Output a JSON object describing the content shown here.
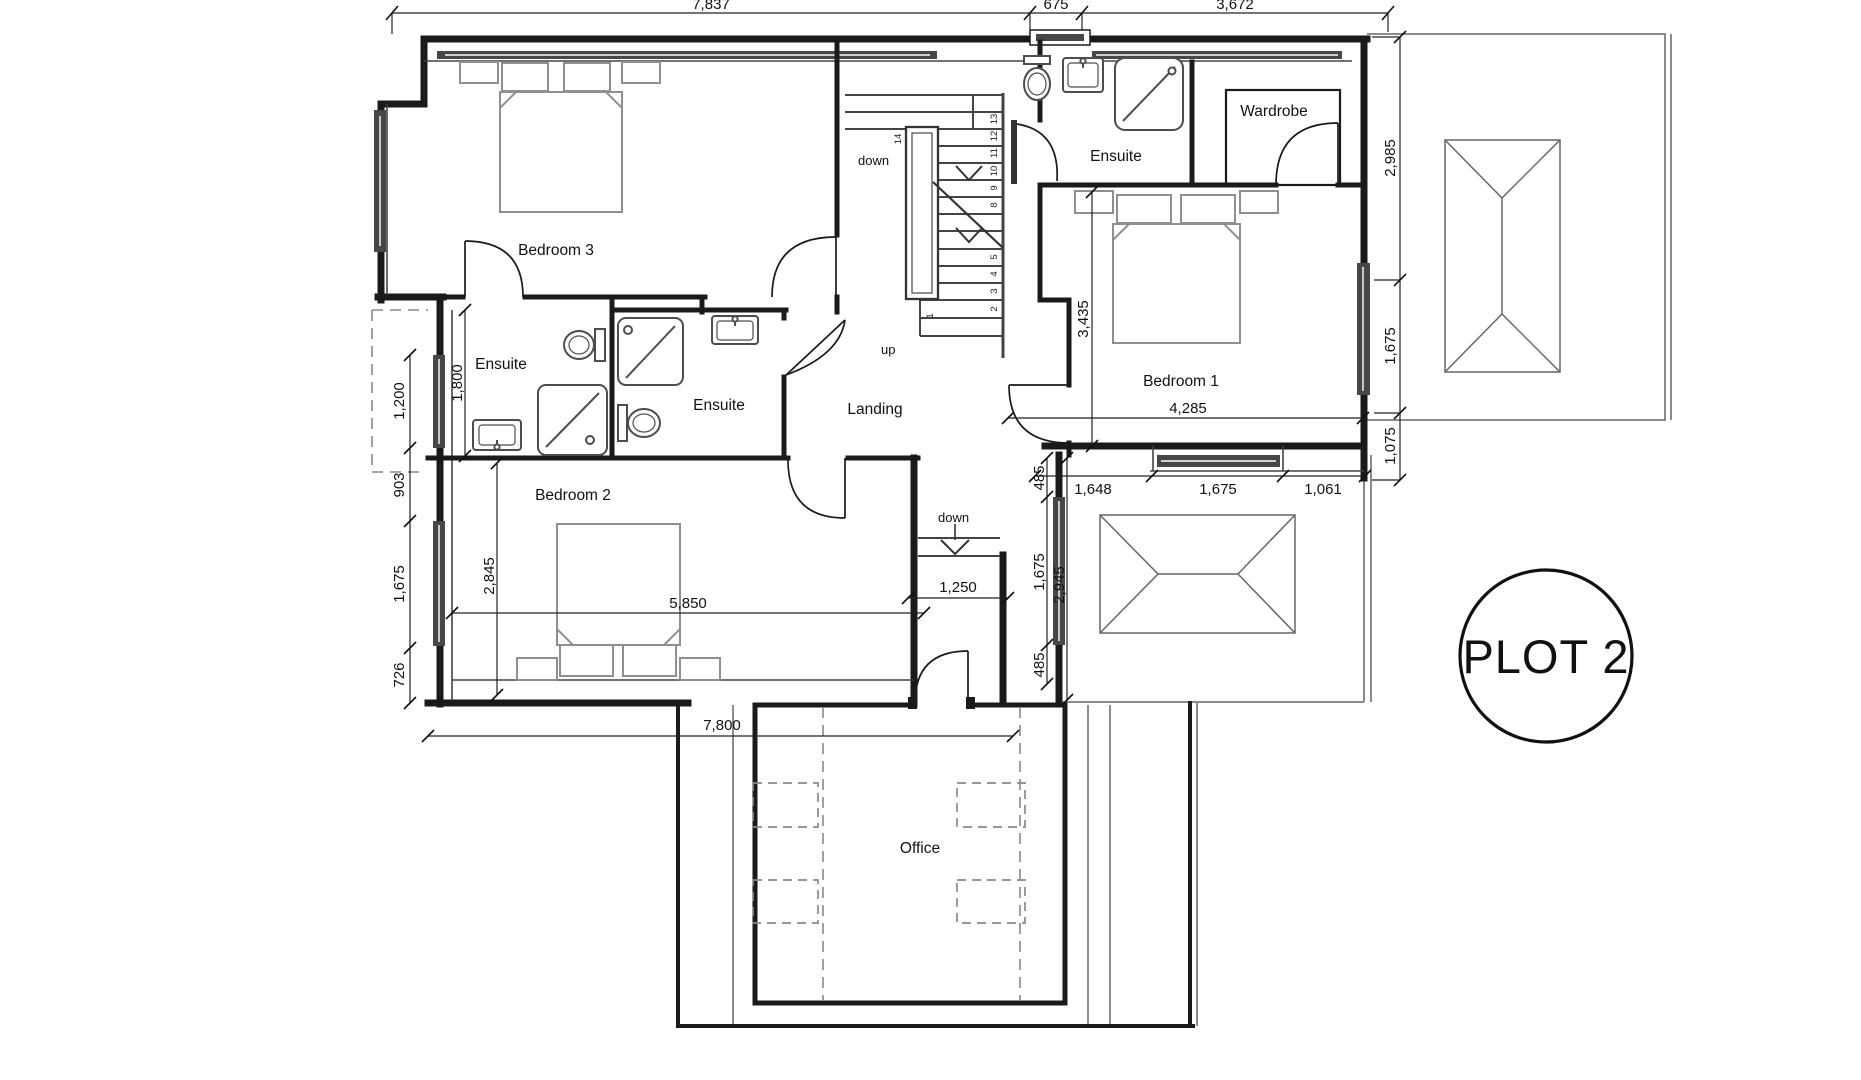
{
  "plot": {
    "label": "PLOT 2"
  },
  "rooms": {
    "bedroom1": "Bedroom 1",
    "bedroom2": "Bedroom 2",
    "bedroom3": "Bedroom 3",
    "ensuite_bedroom3": "Ensuite",
    "ensuite_middle": "Ensuite",
    "ensuite_bedroom1": "Ensuite",
    "wardrobe": "Wardrobe",
    "landing": "Landing",
    "office": "Office"
  },
  "stairs": {
    "down": "down",
    "up": "up",
    "corridor_down": "down",
    "treads": [
      "1",
      "2",
      "3",
      "4",
      "5",
      "8",
      "9",
      "10",
      "11",
      "12",
      "13",
      "14"
    ]
  },
  "dimensions": {
    "top_1": "7,837",
    "top_2": "675",
    "top_3": "3,672",
    "right_1": "2,985",
    "right_2": "1,675",
    "right_3": "1,075",
    "left_1": "1,200",
    "left_2": "903",
    "left_3": "1,675",
    "left_4": "726",
    "ensuite3_height": "1,800",
    "bedroom2_height": "2,845",
    "bedroom2_width": "5,850",
    "bedroom1_height": "3,435",
    "bedroom1_width": "4,285",
    "bottom_1": "1,648",
    "bottom_2": "1,675",
    "bottom_3": "1,061",
    "inner_right_1": "485",
    "inner_right_2": "1,675",
    "inner_right_3": "485",
    "inner_right_total": "2,945",
    "landing_width": "1,250",
    "office_width": "7,800"
  },
  "colors": {
    "line": "#1a1a1a",
    "furniture": "#8f8f8f",
    "glazing": "#474747",
    "background": "#ffffff"
  }
}
